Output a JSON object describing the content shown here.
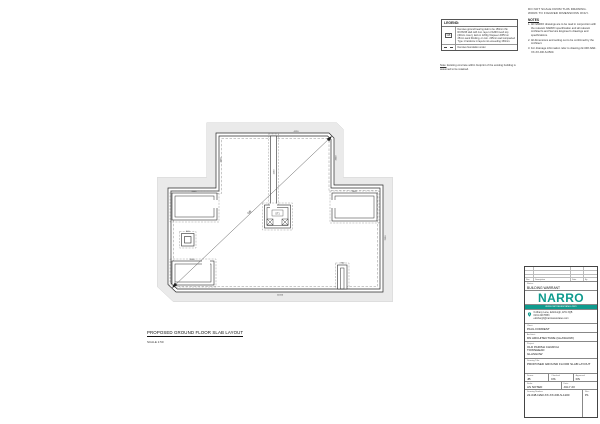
{
  "accent_teal": "#0f9b8e",
  "notes": {
    "disclaimer": "DO NOT SCALE FROM THIS DRAWING. WORK TO FIGURED DIMENSIONS ONLY.",
    "title": "NOTES",
    "items": [
      "1. All NARRO drawings are to be read in conjunction with the relevant NARRO specification and all relevant Architect's and Service Engineer's drawings and specifications.",
      "2. All dimensions and setting out to be confirmed by the Architect.",
      "3. For drainage information refer to drawing 22-048-NAR-XX-XX-DR-S-0500."
    ]
  },
  "legend": {
    "title": "LEGEND:",
    "rows": [
      {
        "symbol": "GB",
        "description": "Denotes ground bearing slab to be 150mm thk RC35/45 slab with 1no. layer of A393 mesh top (40mm cover), laid on 1200g Visqueen DPM on 25mm sand blinding, on min. 225mm well compacted Type 1 hardcore in layers not exceeding 150mm."
      },
      {
        "symbol": "dashed-line",
        "description": "Denotes foundation under."
      }
    ],
    "note_label": "Note:",
    "note_text": " Existing concrete within footprint of the existing building is assumed to be retained."
  },
  "plan": {
    "title": "PROPOSED GROUND FLOOR SLAB LAYOUT",
    "scale": "SCALE 1:50",
    "diagonal_label": "GB",
    "feature_label": "ST1",
    "dims": [
      "4120",
      "3900",
      "3900",
      "1260",
      "7050",
      "14160",
      "2400",
      "2400",
      "2000",
      "900",
      "600"
    ]
  },
  "titleblock": {
    "rev_headers": [
      "Rev",
      "Description",
      "Date",
      "By"
    ],
    "status_label": "Status:",
    "status_value": "BUILDING WARRANT",
    "logo": "NARRO",
    "tagline": "www.narroassociates.com",
    "contact_line1": "6 Albany Lane, Edinburgh, EH1 3QB",
    "contact_line2": "0131 229 5553",
    "contact_line3": "edinburgh@narroassociates.com",
    "client_label": "Client:",
    "client": "PAUL FORREST",
    "architect_label": "Architect:",
    "architect": "DN ARCHITECTURE (GLASGOW)",
    "project_label": "Project:",
    "project_line1": "OLD PARISH CHURCH",
    "project_line2": "TOWNHEAD",
    "project_line3": "GLASGOW",
    "dtitle_label": "Drawing Title:",
    "dtitle": "PROPOSED GROUND FLOOR SLAB LAYOUT",
    "drawn_label": "Drawn:",
    "drawn": "JB",
    "checked_label": "Checked:",
    "checked": "DS",
    "approved_label": "Approved:",
    "approved": "DS",
    "scale_label": "Scale:",
    "scale": "AS NOTED",
    "date_label": "Date:",
    "date": "JULY 23",
    "number_label": "Drawing Number:",
    "number": "22-048-NAR-XX-XX-DR-S-1100",
    "rev_label": "Rev:",
    "rev": "P1"
  }
}
